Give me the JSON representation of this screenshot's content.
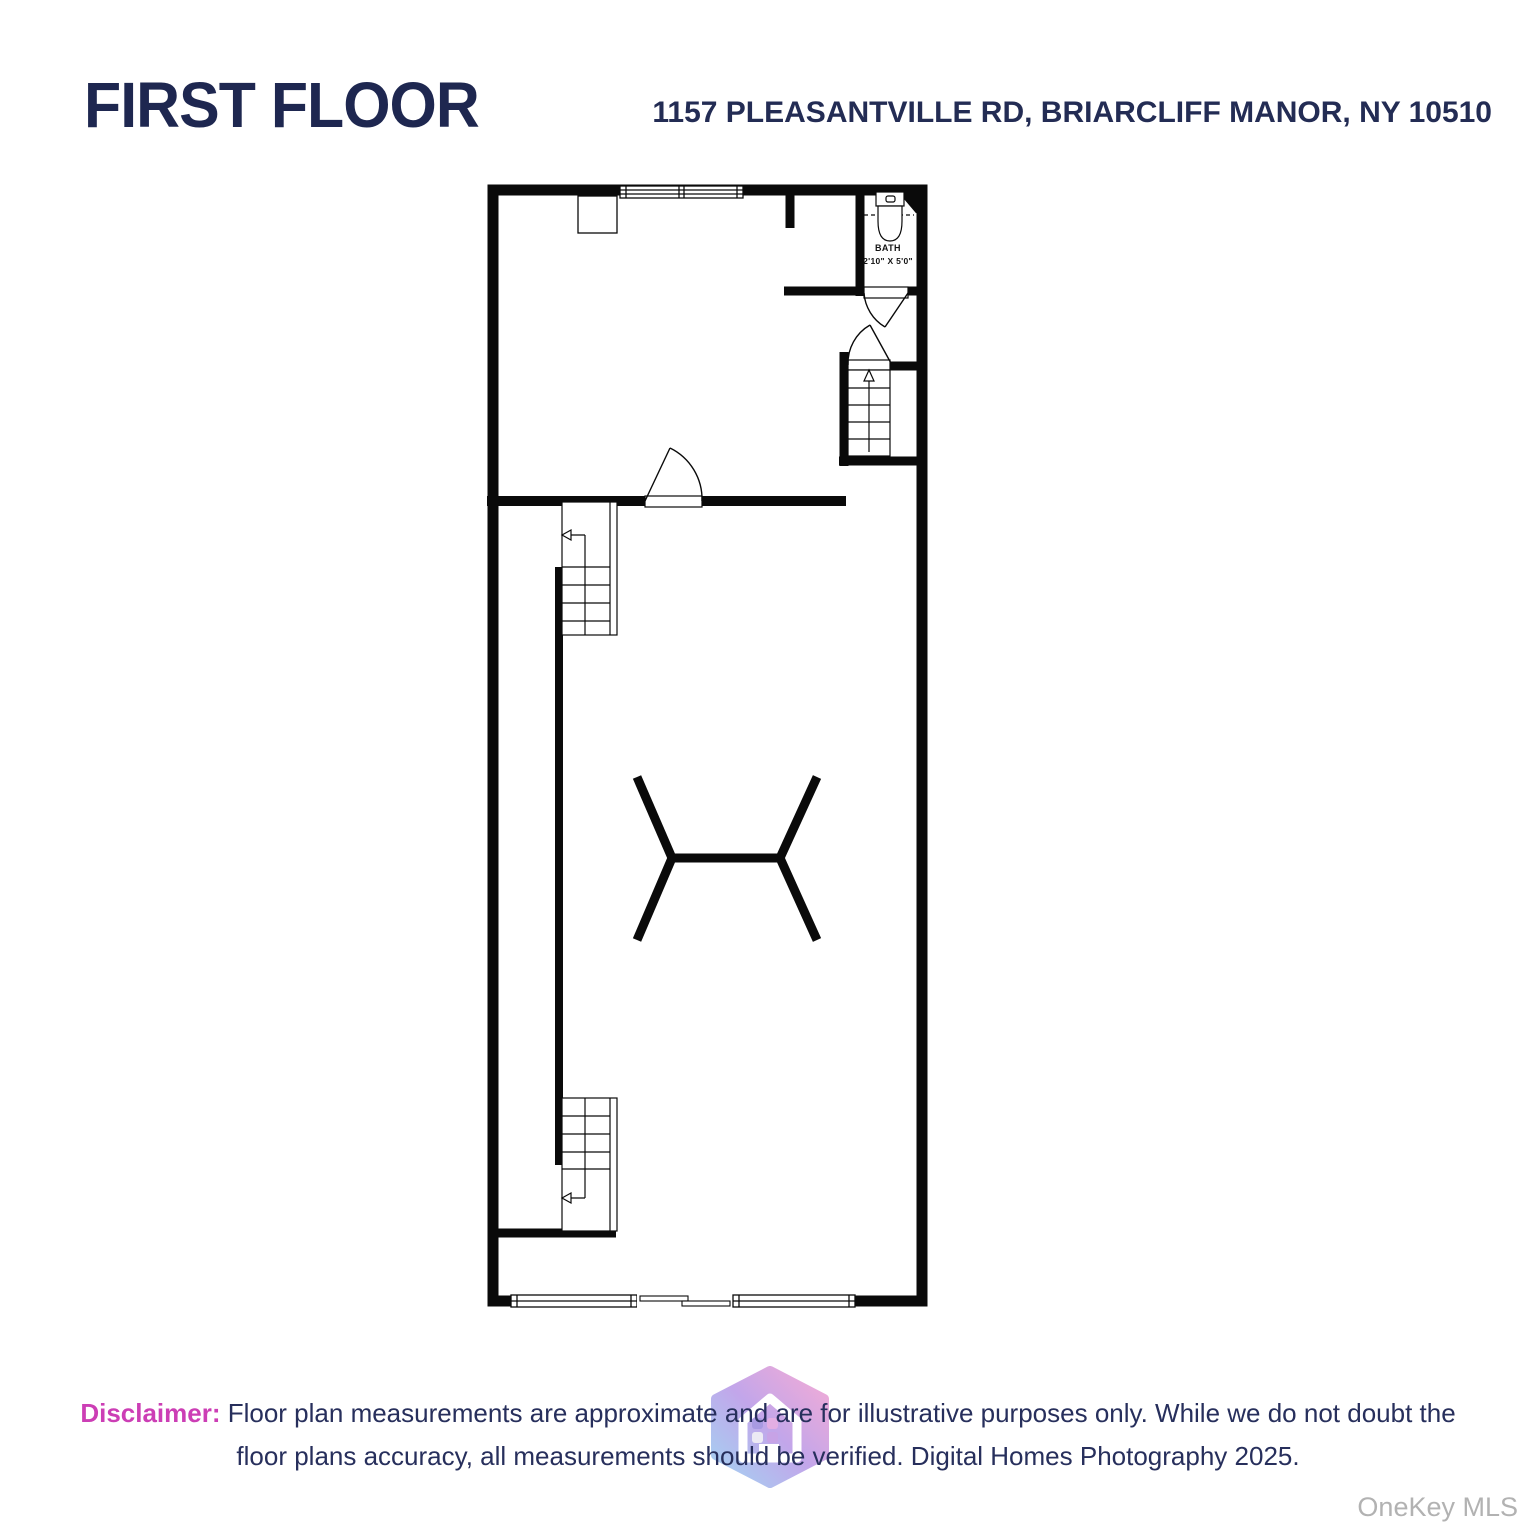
{
  "header": {
    "title": "FIRST FLOOR",
    "address": "1157 PLEASANTVILLE RD, BRIARCLIFF MANOR, NY 10510"
  },
  "floor_plan": {
    "bath": {
      "label": "BATH",
      "dimensions": "2'10\" X 5'0\""
    }
  },
  "disclaimer": {
    "label": "Disclaimer:",
    "text_line1": " Floor plan measurements are approximate and are for illustrative purposes only. While we do not doubt the",
    "text_line2": "floor plans accuracy, all measurements should be verified. Digital Homes Photography 2025."
  },
  "watermark": {
    "mls_text": "OneKey MLS",
    "logo": "digital-homes-hexagon-house-logo"
  },
  "colors": {
    "navy_text": "#232c54",
    "magenta_label": "#cc3eb5",
    "plan_line": "#0a0a0a",
    "mls_gray": "#b2b2b2",
    "logo_gradient": [
      "#a3d3f2",
      "#c2a6ea",
      "#f3abd6"
    ]
  }
}
